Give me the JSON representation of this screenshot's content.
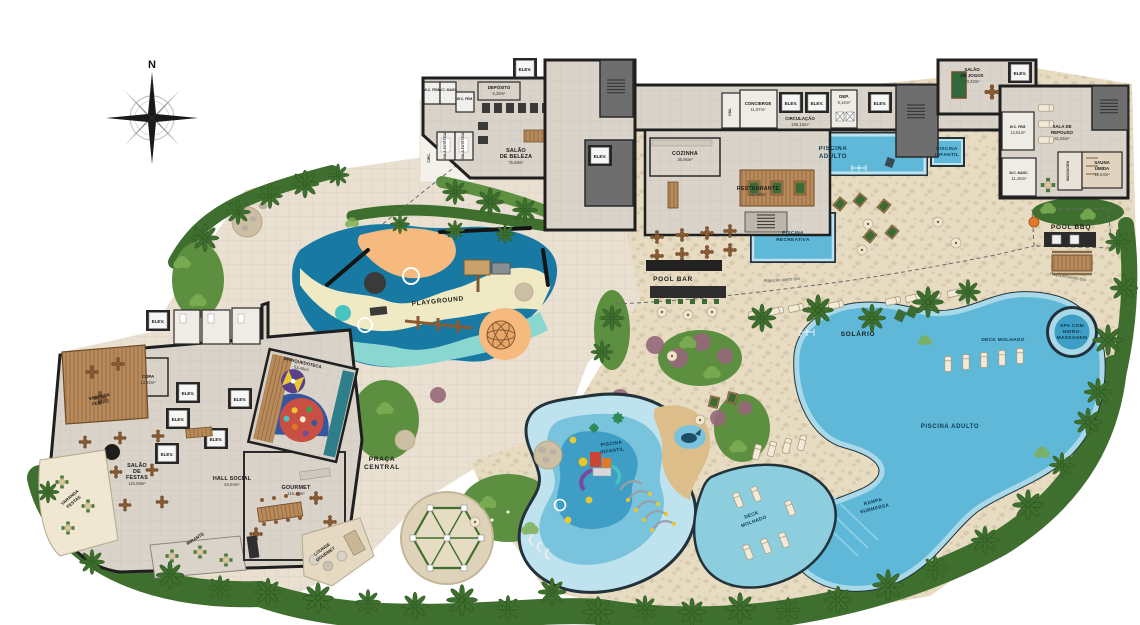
{
  "compass": {
    "north": "N"
  },
  "labels": {
    "elev": "ELEV.",
    "projecao": "Projeção pavto tipo"
  },
  "beleza_wing": {
    "deposito": {
      "name": "DEPÓSITO",
      "area": "6,29m²"
    },
    "wc_fem_1": {
      "name": "W.C. FEM."
    },
    "wc_masc_1": {
      "name": "W.C. MASC."
    },
    "wc_fem_2": {
      "name": "W.C. FEM."
    },
    "circ": {
      "name": "CIRC."
    },
    "sala_estetica": {
      "name": "SALA ESTÉTICA"
    },
    "salao_beleza": {
      "lines": [
        "SALÃO",
        "DE BELEZA"
      ],
      "area": "75,68m²"
    }
  },
  "central_wing": {
    "cozinha": {
      "name": "COZINHA",
      "area": "35,95m²"
    },
    "restaurante": {
      "name": "RESTAURANTE",
      "area": "117,85m²"
    },
    "dml": {
      "name": "DML"
    },
    "concierge": {
      "name": "CONCIERGE",
      "area": "11,97m²"
    },
    "circulacao": {
      "name": "CIRCULAÇÃO",
      "area": "166,15m²"
    },
    "dep": {
      "name": "DEP.",
      "area": "8,14m²"
    }
  },
  "right_wing": {
    "salao_jogos": {
      "lines": [
        "SALÃO",
        "DE JOGOS"
      ],
      "area": "33,32m²"
    },
    "sala_repouso": {
      "lines": [
        "SALA DE",
        "REPOUSO"
      ],
      "area": "51,65m²"
    },
    "massagem": {
      "name": "MASSAGEM"
    },
    "sauna_umida": {
      "lines": [
        "SAUNA",
        "ÚMIDA"
      ],
      "area": "12,64m²"
    },
    "wc_fem": {
      "name": "W.C. FEM.",
      "area": "12,81m²"
    },
    "wc_masc": {
      "name": "W.C. MASC.",
      "area": "11,46m²"
    },
    "pool_bbq": {
      "name": "POOL BBQ"
    }
  },
  "pool_area": {
    "piscina_adulto_top": {
      "lines": [
        "PISCINA",
        "ADULTO"
      ]
    },
    "piscina_infantil_top": {
      "lines": [
        "PISCINA",
        "INFANTIL"
      ]
    },
    "piscina_recreativa": {
      "lines": [
        "PISCINA",
        "RECREATIVA"
      ]
    },
    "pool_bar": {
      "name": "POOL BAR"
    },
    "solario": {
      "name": "SOLÁRIO"
    },
    "spa": {
      "lines": [
        "SPA COM",
        "HIDRO-",
        "MASSAGEM"
      ]
    },
    "deck_molhado_top": {
      "name": "DECK MOLHADO"
    },
    "piscina_adulto_big": {
      "name": "PISCINA ADULTO"
    },
    "rampa_submersa": {
      "lines": [
        "RAMPA",
        "SUBMERSA"
      ]
    },
    "piscina_infantil_bottom": {
      "lines": [
        "PISCINA",
        "INFANTIL"
      ]
    },
    "deck_molhado_bottom": {
      "lines": [
        "DECK",
        "MOLHADO"
      ]
    }
  },
  "social_wing": {
    "varanda_festas": {
      "lines": [
        "VARANDA",
        "FESTAS"
      ]
    },
    "copa": {
      "name": "COPA",
      "area": "13,32m²"
    },
    "salao_festas": {
      "lines": [
        "SALÃO",
        "DE",
        "FESTAS"
      ],
      "area": "110,09m²"
    },
    "hall_social": {
      "name": "HALL SOCIAL",
      "area": "64,94m²"
    },
    "mirante": {
      "name": "MIRANTE"
    },
    "gourmet": {
      "name": "GOURMET",
      "area": "115,47m²"
    },
    "lounge_gourmet": {
      "lines": [
        "LOUNGE",
        "GOURMET"
      ]
    },
    "brinquedoteca": {
      "name": "BRINQUEDOTECA",
      "area": "53,40m²"
    }
  },
  "outdoor": {
    "playground": {
      "name": "PLAYGROUND"
    },
    "praca_central": {
      "lines": [
        "PRAÇA",
        "CENTRAL"
      ]
    }
  },
  "colors": {
    "paving": "#eae0d2",
    "stone": "#e7dcc2",
    "floor": "#d9d3c9",
    "wall": "#1f1f1f",
    "water": "#5fb8d8",
    "water_deep": "#3e9ec6",
    "water_light": "#a9d9e8",
    "water_pale": "#bfe3ee",
    "sand": "#ddbe8a",
    "green_dark": "#3f6f2e",
    "green_mid": "#5c8f3f",
    "green_light": "#7fae54",
    "wood": "#b98a5a",
    "pg_orange": "#f6b97e",
    "pg_blue": "#1879a3",
    "pg_teal": "#8ad6d0",
    "pg_cream": "#efe9c4",
    "label": "#1c1c1c",
    "water_label": "#0d3a52",
    "purple_tree": "#96687a"
  }
}
